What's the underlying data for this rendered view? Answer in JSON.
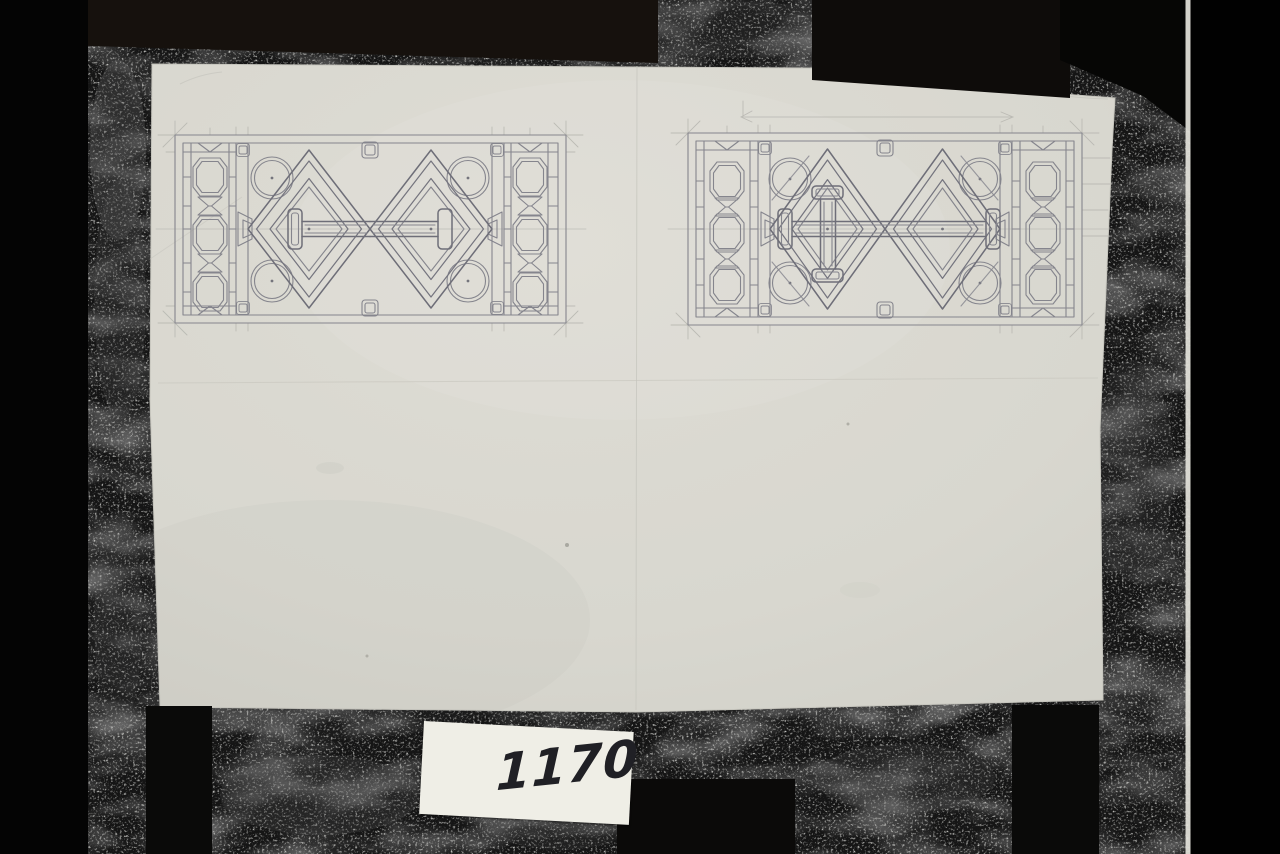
{
  "catalog_label": {
    "number": "1170"
  },
  "sheet": {
    "panels": [
      {
        "name": "grille-panel-study-a"
      },
      {
        "name": "grille-panel-study-b"
      }
    ]
  },
  "colors": {
    "backdrop": "#030303",
    "texture_base": "#151515",
    "clamp_bar": "#16110d",
    "paper": "#d9d8d0",
    "label_paper": "#efeee6",
    "pencil": "#85858d",
    "pencil_heavy": "#6e6e78",
    "pencil_light": "#b7b6b0",
    "handwriting_ink": "#202025",
    "photo_edge_line": "#e4e3db"
  }
}
